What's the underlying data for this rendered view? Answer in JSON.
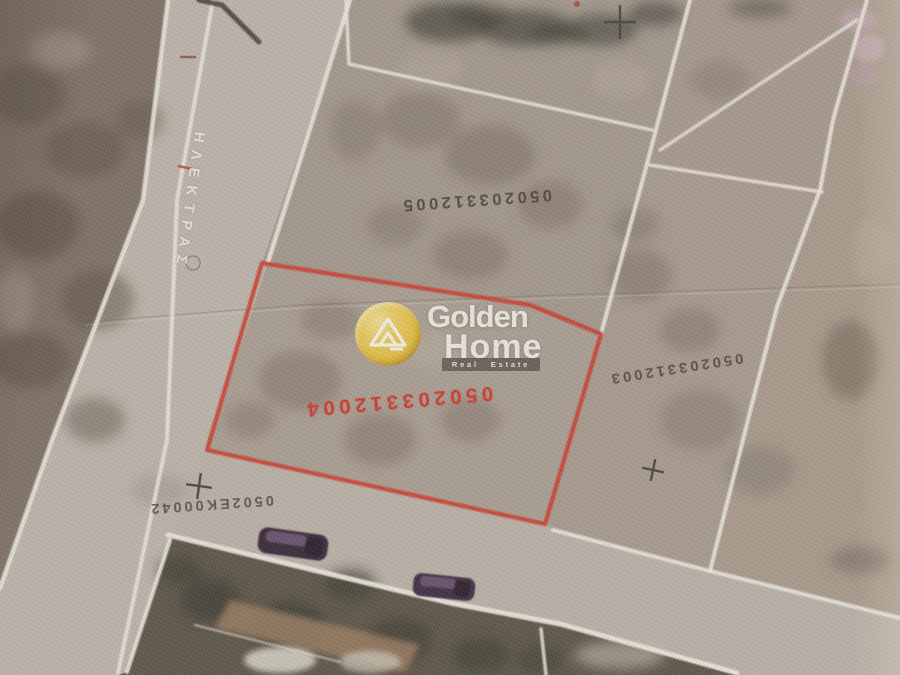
{
  "colors": {
    "highlight_red": "#cf372c",
    "boundary_white": "#f1ede4",
    "label_dark": "#493e34",
    "street_label_white": "#ece8df",
    "terrain_base": "#ab9f93",
    "terrain_dark_field": "#7d6f62",
    "road_surface": "#bfb6ac",
    "vegetation_dark": "#585243",
    "logo_gold": "#e8c23b",
    "logo_text": "#f5f2eb",
    "car_purple": "#372440"
  },
  "map": {
    "street_label": "ΗΛΕΚΤΡΑΣ",
    "parcel_codes": {
      "top": "050203312005",
      "highlighted": "050203312004",
      "right": "050203312003",
      "road": "0502ΕΚ00042"
    }
  },
  "watermark": {
    "brand_word1": "Golden",
    "brand_word2": "Home",
    "tagline": "Real Estate"
  }
}
